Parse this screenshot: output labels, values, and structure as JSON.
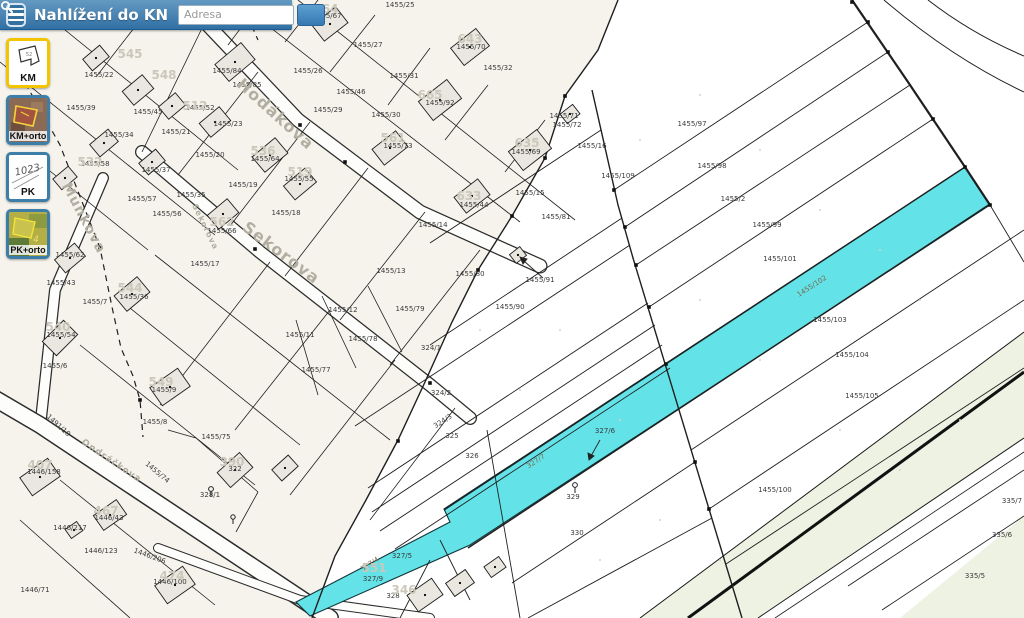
{
  "header": {
    "title": "Nahlížení do KN",
    "search_placeholder": "Adresa",
    "menu_icon": "hamburger-icon",
    "search_icon": "magnifier-icon"
  },
  "layers": [
    {
      "id": "km",
      "label": "KM",
      "selected": true
    },
    {
      "id": "kmorto",
      "label": "KM+orto",
      "selected": false
    },
    {
      "id": "pk",
      "label": "PK",
      "selected": false
    },
    {
      "id": "pkorto",
      "label": "PK+orto",
      "selected": false
    }
  ],
  "map": {
    "highlight_color": "#63e3e8",
    "highlighted_parcels": [
      "1455/102",
      "327/7",
      "327/4"
    ],
    "labels": [
      {
        "t": "1455/88",
        "x": 252,
        "y": 16
      },
      {
        "t": "1455/25",
        "x": 400,
        "y": 7
      },
      {
        "t": "1455/67",
        "x": 327,
        "y": 18
      },
      {
        "t": "1455/27",
        "x": 368,
        "y": 47
      },
      {
        "t": "1455/70",
        "x": 471,
        "y": 49
      },
      {
        "t": "1455/32",
        "x": 498,
        "y": 70
      },
      {
        "t": "1455/31",
        "x": 404,
        "y": 78
      },
      {
        "t": "1455/26",
        "x": 308,
        "y": 73
      },
      {
        "t": "1455/46",
        "x": 351,
        "y": 94
      },
      {
        "t": "1455/29",
        "x": 328,
        "y": 112
      },
      {
        "t": "1455/30",
        "x": 386,
        "y": 117
      },
      {
        "t": "1455/92",
        "x": 440,
        "y": 105
      },
      {
        "t": "1455/73",
        "x": 398,
        "y": 148
      },
      {
        "t": "1455/71",
        "x": 564,
        "y": 118
      },
      {
        "t": "1455/69",
        "x": 526,
        "y": 154
      },
      {
        "t": "1455/72",
        "x": 567,
        "y": 127
      },
      {
        "t": "1455/84",
        "x": 227,
        "y": 73
      },
      {
        "t": "1455/85",
        "x": 247,
        "y": 87
      },
      {
        "t": "1455/22",
        "x": 99,
        "y": 77
      },
      {
        "t": "1455/39",
        "x": 81,
        "y": 110
      },
      {
        "t": "1455/45",
        "x": 148,
        "y": 114
      },
      {
        "t": "1455/52",
        "x": 200,
        "y": 110
      },
      {
        "t": "1455/23",
        "x": 228,
        "y": 126
      },
      {
        "t": "1455/34",
        "x": 119,
        "y": 137
      },
      {
        "t": "1455/21",
        "x": 176,
        "y": 134
      },
      {
        "t": "1455/20",
        "x": 210,
        "y": 157
      },
      {
        "t": "1455/64",
        "x": 265,
        "y": 161
      },
      {
        "t": "1455/58",
        "x": 95,
        "y": 166
      },
      {
        "t": "1455/37",
        "x": 156,
        "y": 172
      },
      {
        "t": "1455/55",
        "x": 299,
        "y": 181
      },
      {
        "t": "1455/35",
        "x": 191,
        "y": 197
      },
      {
        "t": "1455/57",
        "x": 142,
        "y": 201
      },
      {
        "t": "1455/19",
        "x": 243,
        "y": 187
      },
      {
        "t": "1455/56",
        "x": 167,
        "y": 216
      },
      {
        "t": "1455/18",
        "x": 286,
        "y": 215
      },
      {
        "t": "1455/66",
        "x": 222,
        "y": 233
      },
      {
        "t": "1455/17",
        "x": 205,
        "y": 266
      },
      {
        "t": "1455/42",
        "x": 22,
        "y": 255
      },
      {
        "t": "1455/62",
        "x": 70,
        "y": 257
      },
      {
        "t": "1455/43",
        "x": 61,
        "y": 285
      },
      {
        "t": "1455/7",
        "x": 95,
        "y": 304
      },
      {
        "t": "1455/36",
        "x": 134,
        "y": 299
      },
      {
        "t": "1455/54",
        "x": 61,
        "y": 337
      },
      {
        "t": "1455/6",
        "x": 55,
        "y": 368
      },
      {
        "t": "1455/9",
        "x": 164,
        "y": 392
      },
      {
        "t": "1455/8",
        "x": 155,
        "y": 424
      },
      {
        "t": "1455/11",
        "x": 300,
        "y": 337
      },
      {
        "t": "1455/12",
        "x": 343,
        "y": 312
      },
      {
        "t": "1455/79",
        "x": 410,
        "y": 311
      },
      {
        "t": "1455/78",
        "x": 363,
        "y": 341
      },
      {
        "t": "1455/77",
        "x": 316,
        "y": 372
      },
      {
        "t": "1455/13",
        "x": 391,
        "y": 273
      },
      {
        "t": "1455/14",
        "x": 433,
        "y": 227
      },
      {
        "t": "1455/44",
        "x": 474,
        "y": 207
      },
      {
        "t": "1455/15",
        "x": 530,
        "y": 195
      },
      {
        "t": "1455/16",
        "x": 592,
        "y": 148
      },
      {
        "t": "1455/81",
        "x": 556,
        "y": 219
      },
      {
        "t": "1455/91",
        "x": 540,
        "y": 282
      },
      {
        "t": "1455/80",
        "x": 470,
        "y": 276
      },
      {
        "t": "1455/90",
        "x": 510,
        "y": 309
      },
      {
        "t": "1455/109",
        "x": 618,
        "y": 178
      },
      {
        "t": "1455/97",
        "x": 692,
        "y": 126
      },
      {
        "t": "1455/98",
        "x": 712,
        "y": 168
      },
      {
        "t": "1455/2",
        "x": 733,
        "y": 201
      },
      {
        "t": "1455/99",
        "x": 767,
        "y": 227
      },
      {
        "t": "1455/101",
        "x": 780,
        "y": 261
      },
      {
        "t": "1455/102",
        "x": 813,
        "y": 288,
        "r": -33,
        "k": "c"
      },
      {
        "t": "1455/103",
        "x": 830,
        "y": 322
      },
      {
        "t": "1455/104",
        "x": 852,
        "y": 357
      },
      {
        "t": "1455/105",
        "x": 862,
        "y": 398
      },
      {
        "t": "1455/100",
        "x": 775,
        "y": 492
      },
      {
        "t": "324/1",
        "x": 431,
        "y": 350
      },
      {
        "t": "324/2",
        "x": 441,
        "y": 395
      },
      {
        "t": "324/3",
        "x": 444,
        "y": 423,
        "r": -33
      },
      {
        "t": "325",
        "x": 452,
        "y": 438
      },
      {
        "t": "326",
        "x": 472,
        "y": 458
      },
      {
        "t": "327/7",
        "x": 537,
        "y": 463,
        "r": -33,
        "k": "c"
      },
      {
        "t": "327/6",
        "x": 605,
        "y": 433
      },
      {
        "t": "327/4",
        "x": 371,
        "y": 566,
        "r": -33,
        "k": "c"
      },
      {
        "t": "329",
        "x": 573,
        "y": 499
      },
      {
        "t": "330",
        "x": 577,
        "y": 535
      },
      {
        "t": "327/5",
        "x": 402,
        "y": 558
      },
      {
        "t": "327/9",
        "x": 373,
        "y": 581
      },
      {
        "t": "328",
        "x": 393,
        "y": 598
      },
      {
        "t": "328/1",
        "x": 210,
        "y": 497
      },
      {
        "t": "322",
        "x": 235,
        "y": 471
      },
      {
        "t": "1455/75",
        "x": 216,
        "y": 439
      },
      {
        "t": "1455/74",
        "x": 156,
        "y": 474,
        "r": 40
      },
      {
        "t": "1446/158",
        "x": 44,
        "y": 474
      },
      {
        "t": "1446/217",
        "x": 70,
        "y": 530
      },
      {
        "t": "1446/43",
        "x": 109,
        "y": 520
      },
      {
        "t": "1446/123",
        "x": 101,
        "y": 553
      },
      {
        "t": "1446/71",
        "x": 35,
        "y": 592
      },
      {
        "t": "1446/100",
        "x": 170,
        "y": 584
      },
      {
        "t": "1446/206",
        "x": 149,
        "y": 558,
        "r": 20
      },
      {
        "t": "1491/18",
        "x": 57,
        "y": 427,
        "r": 42
      },
      {
        "t": "335/7",
        "x": 1012,
        "y": 503
      },
      {
        "t": "335/6",
        "x": 1002,
        "y": 537
      },
      {
        "t": "335/5",
        "x": 975,
        "y": 578
      },
      {
        "t": "545",
        "x": 130,
        "y": 58,
        "k": "g"
      },
      {
        "t": "548",
        "x": 164,
        "y": 79,
        "k": "g"
      },
      {
        "t": "564",
        "x": 326,
        "y": 13,
        "k": "g"
      },
      {
        "t": "643",
        "x": 470,
        "y": 43,
        "k": "g"
      },
      {
        "t": "512",
        "x": 195,
        "y": 110,
        "k": "g"
      },
      {
        "t": "532",
        "x": 90,
        "y": 166,
        "k": "g"
      },
      {
        "t": "536",
        "x": 263,
        "y": 155,
        "k": "g"
      },
      {
        "t": "519",
        "x": 300,
        "y": 176,
        "k": "g"
      },
      {
        "t": "562",
        "x": 222,
        "y": 226,
        "k": "g"
      },
      {
        "t": "665",
        "x": 430,
        "y": 99,
        "k": "g"
      },
      {
        "t": "561",
        "x": 393,
        "y": 142,
        "k": "g"
      },
      {
        "t": "635",
        "x": 527,
        "y": 147,
        "k": "g"
      },
      {
        "t": "633",
        "x": 469,
        "y": 200,
        "k": "g"
      },
      {
        "t": "544",
        "x": 130,
        "y": 292,
        "k": "g"
      },
      {
        "t": "540",
        "x": 58,
        "y": 331,
        "k": "g"
      },
      {
        "t": "549",
        "x": 161,
        "y": 386,
        "k": "g"
      },
      {
        "t": "407",
        "x": 40,
        "y": 469,
        "k": "g"
      },
      {
        "t": "467",
        "x": 106,
        "y": 515,
        "k": "g"
      },
      {
        "t": "474",
        "x": 172,
        "y": 580,
        "k": "g"
      },
      {
        "t": "390",
        "x": 232,
        "y": 466,
        "k": "g"
      },
      {
        "t": "551",
        "x": 374,
        "y": 572,
        "k": "g"
      },
      {
        "t": "346",
        "x": 404,
        "y": 594,
        "k": "g"
      },
      {
        "t": "Hodákova",
        "x": 272,
        "y": 118,
        "r": 42,
        "k": "s",
        "fs": 16
      },
      {
        "t": "Sekorova",
        "x": 278,
        "y": 257,
        "r": 37,
        "k": "s",
        "fs": 16
      },
      {
        "t": "Sekorova",
        "x": 203,
        "y": 228,
        "r": 64,
        "k": "s",
        "fs": 8
      },
      {
        "t": "Munkova",
        "x": 80,
        "y": 220,
        "r": 62,
        "k": "s",
        "fs": 14
      },
      {
        "t": "Ondráčkova",
        "x": 110,
        "y": 463,
        "r": 34,
        "k": "s",
        "fs": 9
      }
    ]
  }
}
